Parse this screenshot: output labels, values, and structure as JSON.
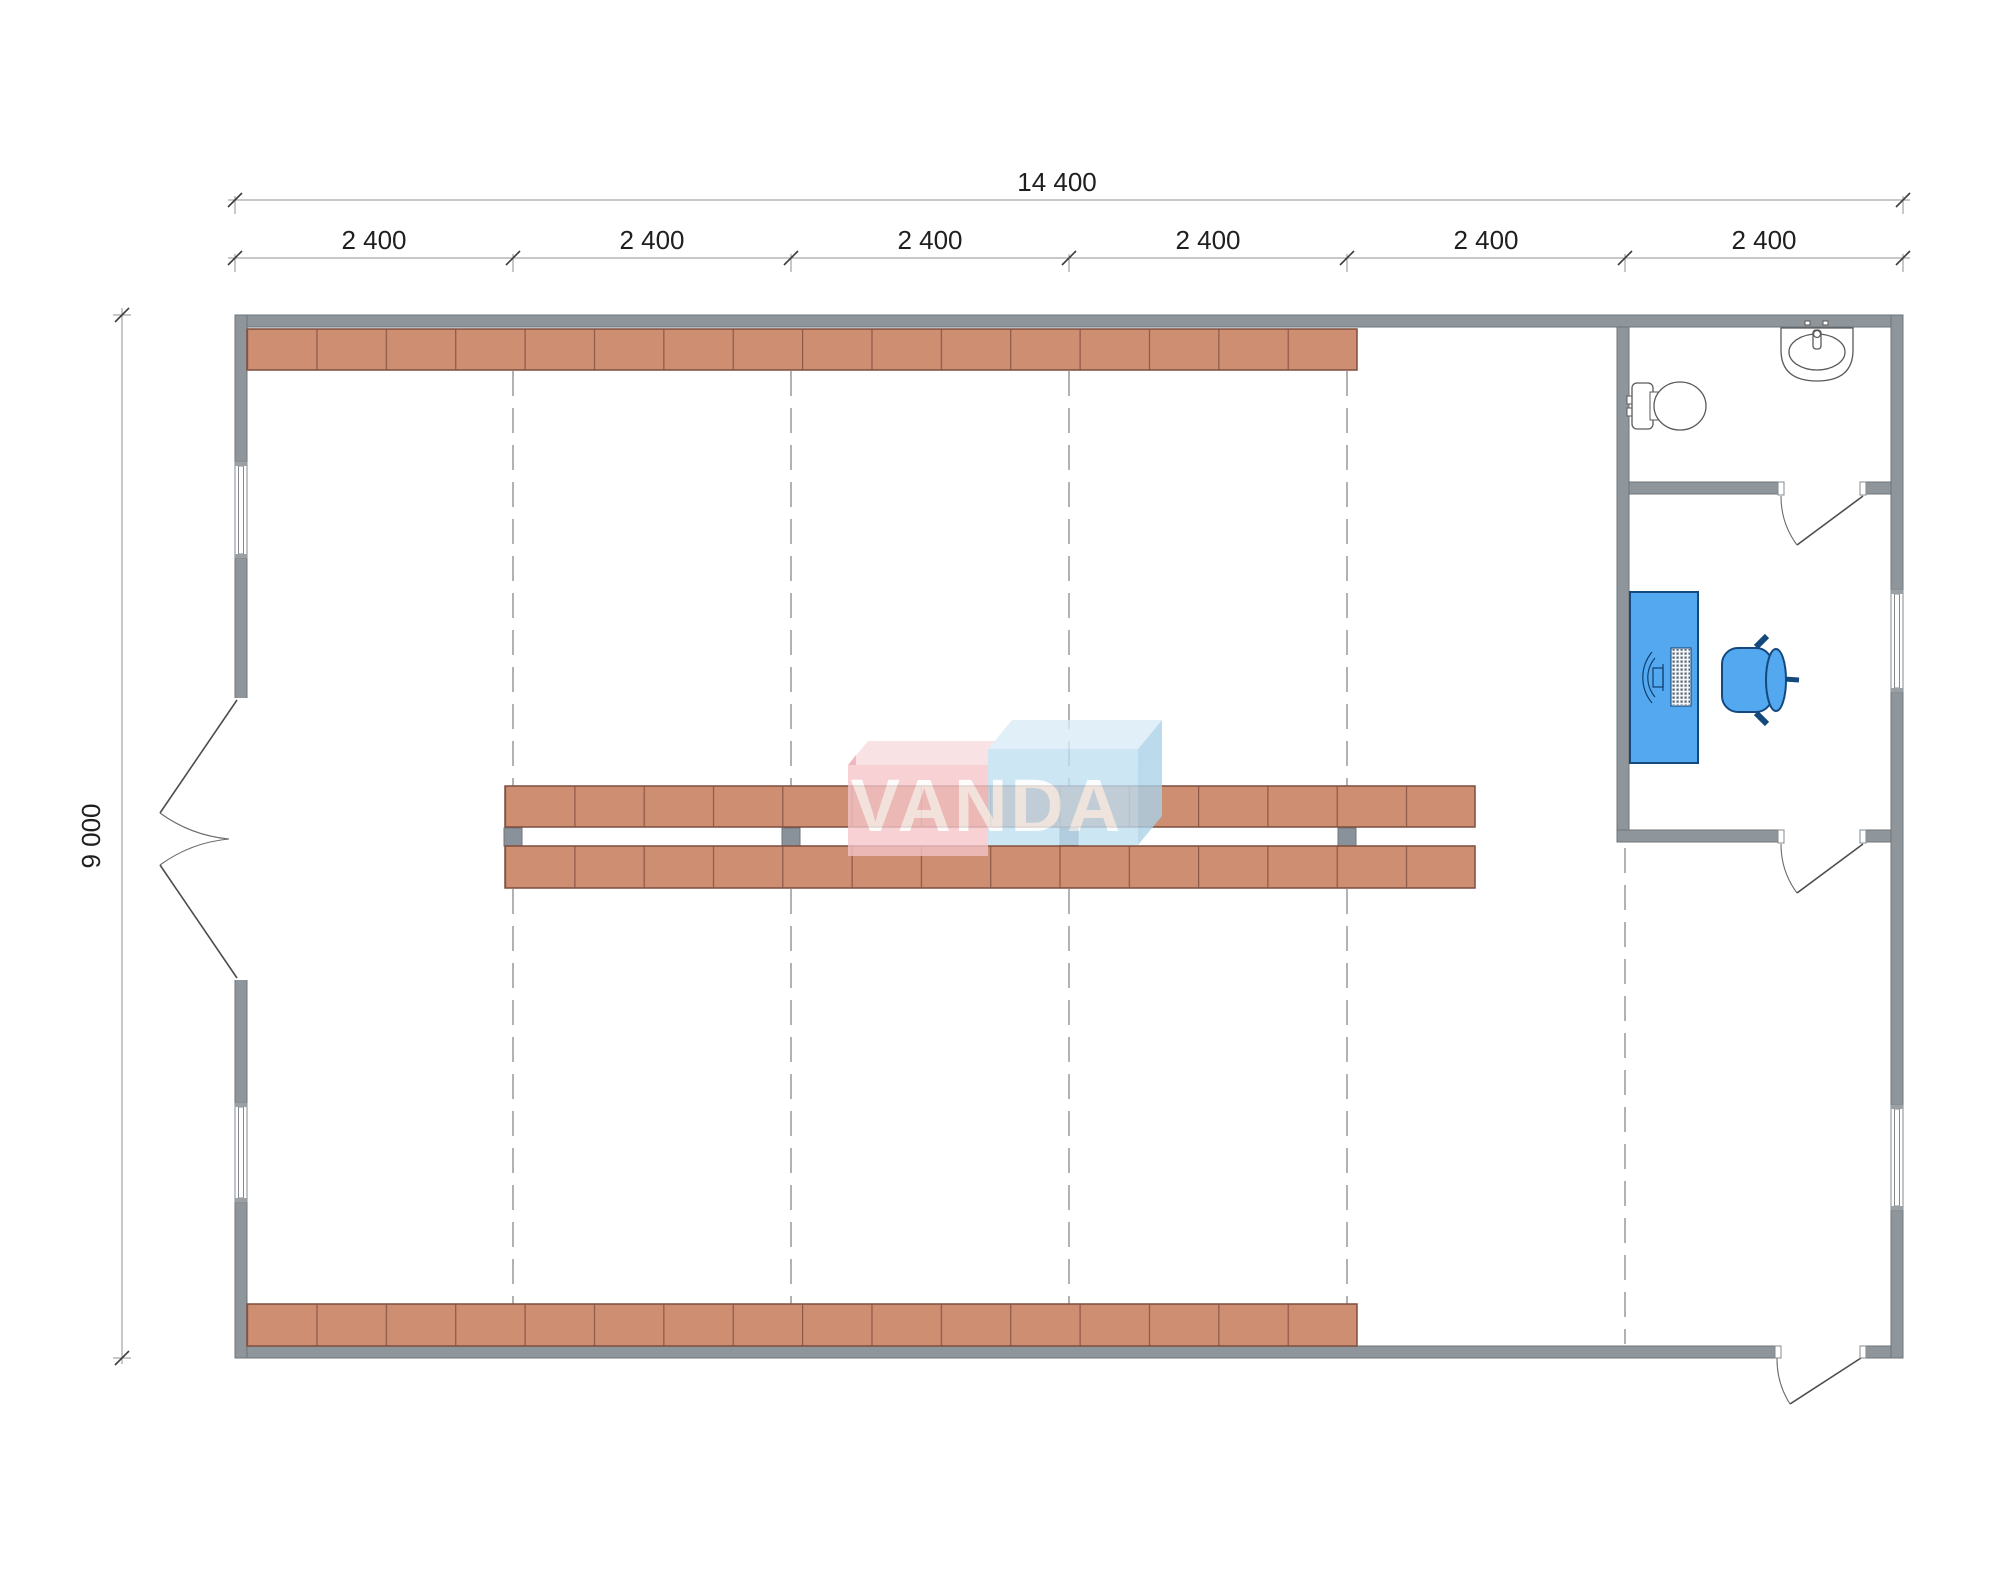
{
  "drawing": {
    "type": "floor-plan",
    "watermark": {
      "text": "VANDA"
    },
    "dimensions": {
      "overall_width": "14 400",
      "overall_height": "9 000",
      "bays": [
        "2 400",
        "2 400",
        "2 400",
        "2 400",
        "2 400",
        "2 400"
      ]
    },
    "grid": {
      "bay_count": 6,
      "bay_size_mm": 2400,
      "width_mm": 14400,
      "height_mm": 9000
    },
    "fixtures": [
      "toilet",
      "sink",
      "desk",
      "office-chair",
      "shelving"
    ],
    "colors": {
      "wall_gray": "#8f969b",
      "wall_border": "#6f767b",
      "shelf_tan": "#cd8e72",
      "shelf_border": "#7e4f40",
      "post_gray": "#89919a",
      "furniture_blue": "#54a8f0",
      "furniture_border": "#14497e",
      "grid_dash_gray": "#7f7f7f",
      "dimension_text": "#1f1f1f",
      "watermark_pink": "#f5c5c9",
      "watermark_blue": "#bedff2"
    }
  }
}
